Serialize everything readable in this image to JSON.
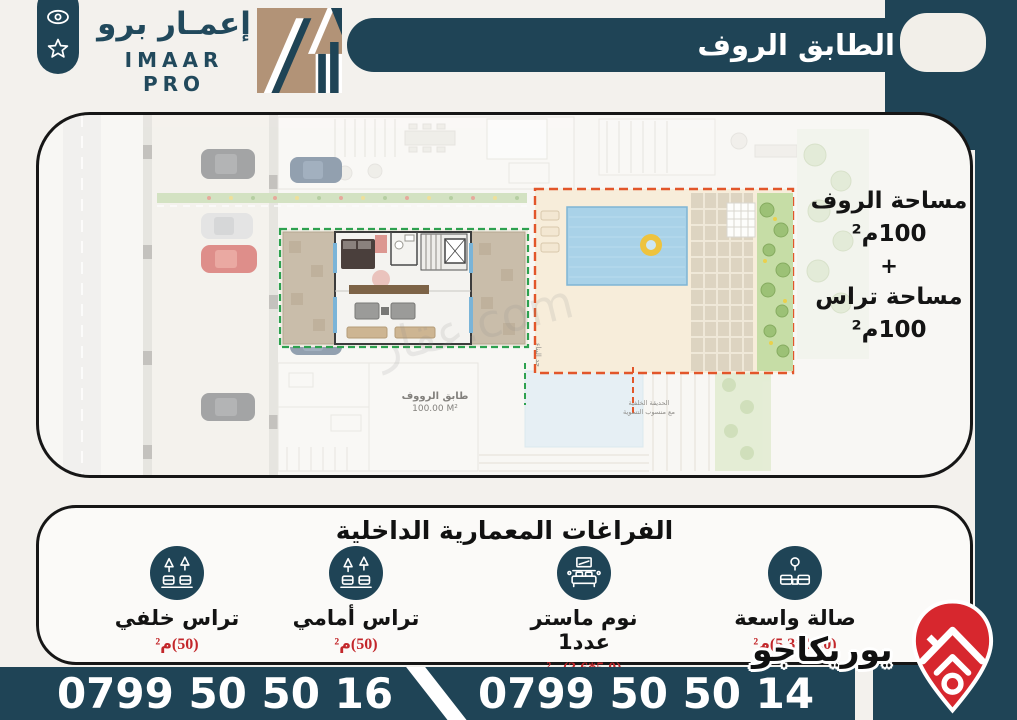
{
  "colors": {
    "teal": "#1f4456",
    "tan": "#b29377",
    "accent_red": "#c3272b",
    "pin_red": "#d7272e",
    "plan_green_dash": "#2ea14f",
    "plan_orange_dash": "#e2562a"
  },
  "brand": {
    "name_ar": "إعمـار برو",
    "name_en": "IMAAR PRO"
  },
  "banner": {
    "title": "الطابق الروف"
  },
  "plan": {
    "area_block": {
      "line1": "مساحة الروف",
      "line2": "100م²",
      "line3": "+",
      "line4": "مساحة تراس",
      "line5": "100م²"
    },
    "floor_label": "طابق الرووف",
    "floor_area": "100.00 M²",
    "boundary_label": "حد البناء",
    "garden_label_1": "الحديقة الخلفية",
    "garden_label_2": "مع منسوب التسوية",
    "watermark": "عقار.com"
  },
  "features": {
    "title": "الفراغات المعمارية الداخلية",
    "items": [
      {
        "label": "صالة واسعة",
        "value": "(10.0*5.3)م²",
        "icon": "sofa-icon"
      },
      {
        "label": "نوم ماستر عدد1",
        "value": "(5.0*3.6)م²",
        "icon": "bed-icon"
      },
      {
        "label": "تراس أمامي",
        "value": "(50)م²",
        "icon": "terrace-icon"
      },
      {
        "label": "تراس خلفي",
        "value": "(50)م²",
        "icon": "terrace-icon"
      }
    ]
  },
  "footer": {
    "phone_left": "0799 50 50 16",
    "phone_right": "0799 50 50 14"
  },
  "site_logo": {
    "name": "يوريكاجو"
  }
}
